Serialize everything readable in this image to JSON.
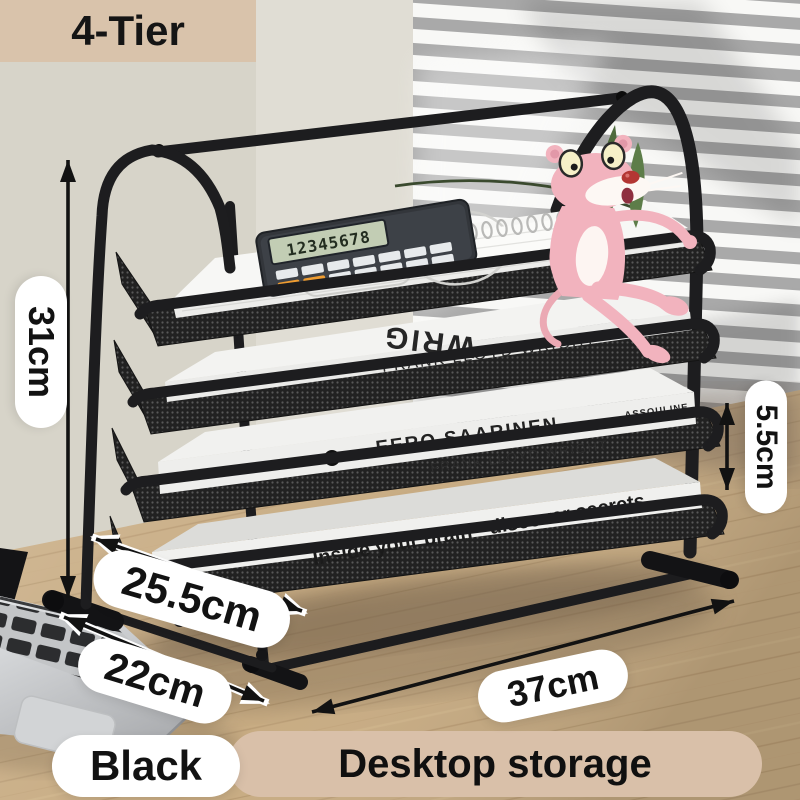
{
  "badges": {
    "tier": "4-Tier",
    "color": "Black",
    "category": "Desktop storage"
  },
  "dimensions": {
    "height": "31cm",
    "depth": "25.5cm",
    "front_width": "22cm",
    "width": "37cm",
    "layer_height": "5.5cm"
  },
  "product": {
    "calculator_display": "12345678",
    "books": {
      "cover_title": "WRIG",
      "spine_tray2": "FRANK LLOYD WRIGHT",
      "spine_tray3_top": "EERO SAARINEN",
      "spine_tray3_bottom": "FRANK LLOYD WRIGHT",
      "publisher": "ASSOULINE",
      "spine_tray4": "Inside your brain - discover secrets"
    }
  },
  "colors": {
    "accent_tan": "#d9c3ab",
    "banner_tan": "#d9c0a9",
    "label_pill": "#ffffff",
    "rack_black": "#1d1d1f",
    "desk_wood": "#c8ac83"
  }
}
